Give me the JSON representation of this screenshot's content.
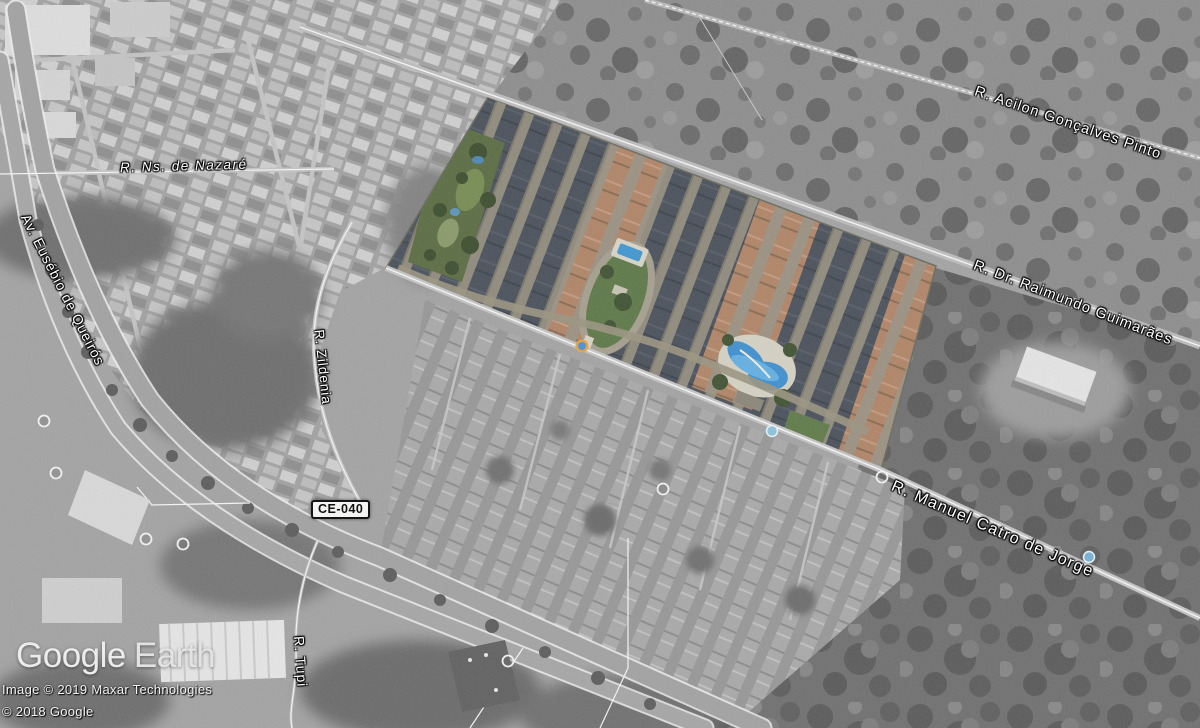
{
  "app": {
    "name": "Google Earth"
  },
  "logo": {
    "google": "Google",
    "earth": "Earth"
  },
  "attribution": {
    "imagery": "Image © 2019 Maxar Technologies",
    "copyright": "© 2018 Google"
  },
  "road_shield": {
    "label": "CE-040"
  },
  "streets": [
    {
      "name": "R. Ns. de Nazaré"
    },
    {
      "name": "Av. Eusébio de Queirós"
    },
    {
      "name": "R. Zildenia"
    },
    {
      "name": "R. Acilon Gonçalves Pinto"
    },
    {
      "name": "R. Dr. Raimundo Guimarães"
    },
    {
      "name": "R. Manuel Catro de Jorge"
    },
    {
      "name": "R. Tupi"
    }
  ],
  "markers": {
    "photo_ring": "white-ring-photo-marker",
    "photosphere": "blue-photosphere-marker",
    "drop_pin": "street-view-drop-marker"
  },
  "colors": {
    "label_text": "#ffffff",
    "road_trace_white": "#f5f5f5",
    "highlight_roof_dark": "#49505a",
    "highlight_roof_terracotta": "#b08466",
    "highlight_green": "#5a6c42",
    "pool_blue": "#3f97d3",
    "satellite_gray": "#a3a3a3"
  }
}
